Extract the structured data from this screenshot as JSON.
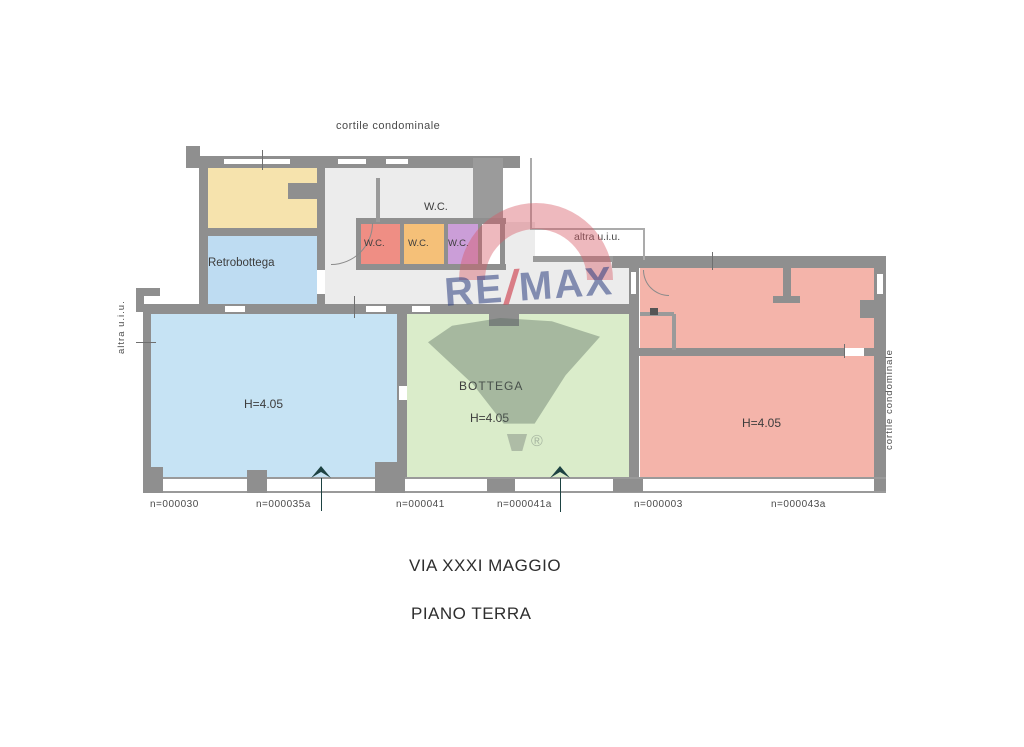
{
  "title_block": {
    "street": "VIA XXXI MAGGIO",
    "floor": "PIANO TERRA"
  },
  "exterior_labels": {
    "courtyard_top": "cortile condominale",
    "courtyard_right": "cortile condominale",
    "other_unit_left": "altra u.i.u.",
    "other_unit_top_right": "altra u.i.u."
  },
  "rooms": {
    "retrobottega": {
      "label": "Retrobottega",
      "color": "#bedcf2"
    },
    "storage_yellow": {
      "color": "#f6e3ad"
    },
    "wc_main": {
      "label": "W.C."
    },
    "wc_small_1": {
      "label": "W.C.",
      "color": "#ef8e84"
    },
    "wc_small_2": {
      "label": "W.C.",
      "color": "#f5c078"
    },
    "wc_small_3": {
      "label": "W.C.",
      "color": "#cb9ed8"
    },
    "shop_left": {
      "height_label": "H=4.05",
      "color": "#c6e3f4"
    },
    "bottega": {
      "label": "BOTTEGA",
      "height_label": "H=4.05",
      "color": "#daecca"
    },
    "unit_right": {
      "height_label": "H=4.05",
      "color": "#f4b4aa"
    }
  },
  "parcel_numbers": [
    "n=000030",
    "n=000035a",
    "n=000041",
    "n=000041a",
    "n=000003",
    "n=000043a"
  ],
  "watermark": {
    "brand_left": "RE",
    "brand_slash": "/",
    "brand_right": "MAX",
    "registered_mark": "®"
  },
  "colors": {
    "wall": "#8f8f8f",
    "corridor": "#ececec",
    "watermark_red": "#d65864",
    "watermark_blue": "#2c3e80",
    "text": "#3d3d3d"
  }
}
